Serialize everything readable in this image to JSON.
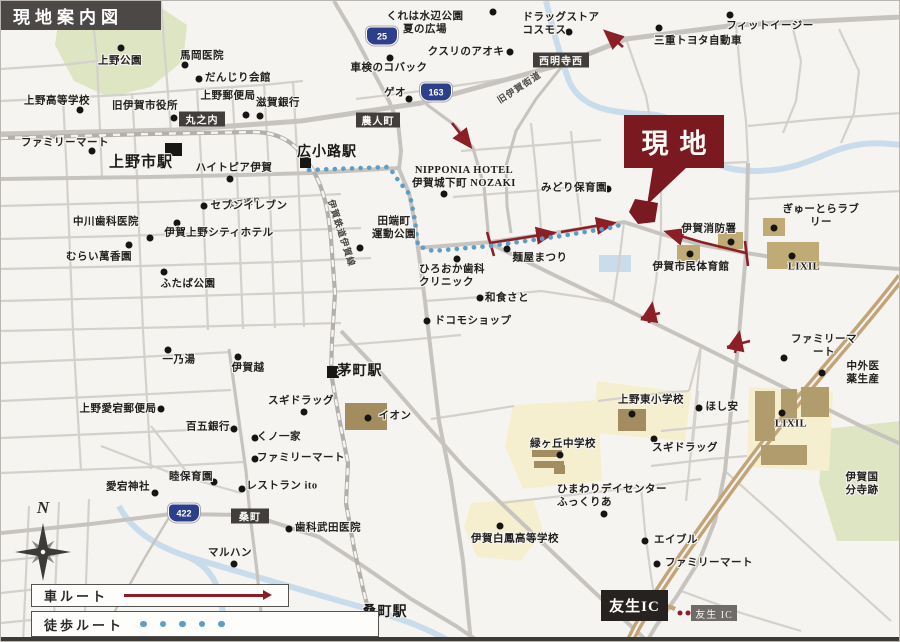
{
  "header": {
    "title": "現地案内図"
  },
  "site": {
    "label": "現地"
  },
  "legend": {
    "car_label": "車ルート",
    "walk_label": "徒歩ルート"
  },
  "compass": {
    "north_label": "N"
  },
  "ic": {
    "primary": "友生IC",
    "secondary": "友生 IC"
  },
  "colors": {
    "site": "#7a1a20",
    "car": "#8c1f26",
    "walk": "#5f9dc6",
    "road": "#c7c4bf",
    "river": "#c9dcec",
    "green": "#dde5c3",
    "campus": "#f6efcf",
    "building": "#c0ab77",
    "highway": "#c2a478"
  },
  "map": {
    "shields": [
      {
        "n": "25",
        "x": 381,
        "y": 35
      },
      {
        "n": "163",
        "x": 435,
        "y": 91
      },
      {
        "n": "422",
        "x": 183,
        "y": 512
      }
    ],
    "dboxes": [
      {
        "t": "丸之内",
        "x": 201,
        "y": 118,
        "w": 46,
        "h": 15
      },
      {
        "t": "農人町",
        "x": 377,
        "y": 119,
        "w": 44,
        "h": 15
      },
      {
        "t": "西明寺西",
        "x": 560,
        "y": 59,
        "w": 56,
        "h": 15
      },
      {
        "t": "桑町",
        "x": 249,
        "y": 515,
        "w": 38,
        "h": 15
      }
    ],
    "stations": [
      {
        "t": "上野市駅",
        "x": 140,
        "y": 160,
        "fs": 15,
        "sq": [
          164,
          142,
          17,
          13
        ]
      },
      {
        "t": "広小路駅",
        "x": 326,
        "y": 150,
        "fs": 14,
        "sq": [
          299,
          156,
          11,
          11
        ]
      },
      {
        "t": "茅町駅",
        "x": 359,
        "y": 369,
        "fs": 14,
        "sq": [
          326,
          365,
          12,
          12
        ]
      },
      {
        "t": "桑町駅",
        "x": 384,
        "y": 610,
        "fs": 14,
        "sq": [
          357,
          616,
          15,
          13
        ]
      }
    ],
    "rotated": [
      {
        "t": "伊賀鉄道伊賀線",
        "x": 341,
        "y": 232,
        "rot": 72,
        "fs": 9
      },
      {
        "t": "旧伊賀街道",
        "x": 518,
        "y": 86,
        "rot": -33,
        "fs": 9
      },
      {
        "t": "本町通り",
        "x": 243,
        "y": 202,
        "rot": -8,
        "fs": 8
      }
    ],
    "pois": [
      {
        "t": "上野公園",
        "x": 119,
        "y": 60,
        "dx": 120,
        "dy": 47
      },
      {
        "t": "馬岡医院",
        "x": 201,
        "y": 55,
        "dx": 184,
        "dy": 64
      },
      {
        "t": "だんじり会館",
        "x": 237,
        "y": 77,
        "dx": 198,
        "dy": 78
      },
      {
        "t": "上野郵便局",
        "x": 227,
        "y": 95,
        "dx": 245,
        "dy": 114
      },
      {
        "t": "滋賀銀行",
        "x": 277,
        "y": 102,
        "dx": 259,
        "dy": 115
      },
      {
        "t": "上野高等学校",
        "x": 56,
        "y": 100,
        "dx": 79,
        "dy": 109
      },
      {
        "t": "旧伊賀市役所",
        "x": 144,
        "y": 105,
        "dx": 173,
        "dy": 117
      },
      {
        "t": "ファミリーマート",
        "x": 64,
        "y": 142,
        "dx": 91,
        "dy": 150
      },
      {
        "t": "ハイトピア伊賀",
        "x": 233,
        "y": 167,
        "dx": 229,
        "dy": 178
      },
      {
        "t": "中川歯科医院",
        "x": 105,
        "y": 221,
        "dx": 149,
        "dy": 237
      },
      {
        "t": "セブンイレブン",
        "x": 248,
        "y": 205,
        "dx": 203,
        "dy": 205
      },
      {
        "t": "伊賀上野シティホテル",
        "x": 218,
        "y": 232,
        "dx": 176,
        "dy": 222
      },
      {
        "t": "むらい萬香園",
        "x": 98,
        "y": 256,
        "dx": 128,
        "dy": 244
      },
      {
        "t": "ふたば公園",
        "x": 187,
        "y": 283,
        "dx": 163,
        "dy": 271
      },
      {
        "t": "くれは水辺公園\n夏の広場",
        "x": 424,
        "y": 22,
        "dx": 492,
        "dy": 11
      },
      {
        "t": "ドラッグストア\nコスモス",
        "x": 560,
        "y": 23,
        "dx": 568,
        "dy": 31,
        "ta": "left"
      },
      {
        "t": "クスリのアオキ",
        "x": 465,
        "y": 51,
        "dx": 509,
        "dy": 51
      },
      {
        "t": "車検のコバック",
        "x": 388,
        "y": 67,
        "dx": 389,
        "dy": 57
      },
      {
        "t": "ゲオ",
        "x": 394,
        "y": 92,
        "dx": 408,
        "dy": 98
      },
      {
        "t": "フィットイージー",
        "x": 769,
        "y": 25,
        "dx": 729,
        "dy": 14
      },
      {
        "t": "三重トヨタ自動車",
        "x": 697,
        "y": 40,
        "dx": 658,
        "dy": 27
      },
      {
        "t": "NIPPONIA HOTEL\n伊賀城下町 NOZAKI",
        "x": 463,
        "y": 176,
        "dx": 443,
        "dy": 193
      },
      {
        "t": "みどり保育園",
        "x": 573,
        "y": 187,
        "dx": 607,
        "dy": 188
      },
      {
        "t": "田端町\n運動公園",
        "x": 393,
        "y": 227,
        "dx": 359,
        "dy": 247
      },
      {
        "t": "ひろおか歯科\nクリニック",
        "x": 451,
        "y": 275,
        "dx": 456,
        "dy": 258,
        "ta": "left"
      },
      {
        "t": "麺屋まつり",
        "x": 539,
        "y": 257,
        "dx": 506,
        "dy": 248
      },
      {
        "t": "和食さと",
        "x": 506,
        "y": 297,
        "dx": 479,
        "dy": 297
      },
      {
        "t": "ドコモショップ",
        "x": 472,
        "y": 320,
        "dx": 426,
        "dy": 320
      },
      {
        "t": "伊賀消防署",
        "x": 708,
        "y": 228,
        "dx": 730,
        "dy": 241
      },
      {
        "t": "ぎゅーとらラブリー",
        "x": 820,
        "y": 215,
        "dx": 773,
        "dy": 227
      },
      {
        "t": "LIXIL",
        "x": 803,
        "y": 266,
        "dx": 791,
        "dy": 255
      },
      {
        "t": "伊賀市民体育館",
        "x": 690,
        "y": 266,
        "dx": 689,
        "dy": 253
      },
      {
        "t": "ファミリーマート",
        "x": 823,
        "y": 345,
        "dx": 783,
        "dy": 357
      },
      {
        "t": "中外医薬生産",
        "x": 862,
        "y": 372,
        "dx": 821,
        "dy": 372
      },
      {
        "t": "一乃湯",
        "x": 178,
        "y": 359,
        "dx": 167,
        "dy": 349
      },
      {
        "t": "伊賀越",
        "x": 247,
        "y": 367,
        "dx": 237,
        "dy": 356
      },
      {
        "t": "上野愛宕郵便局",
        "x": 117,
        "y": 408,
        "dx": 160,
        "dy": 408
      },
      {
        "t": "百五銀行",
        "x": 207,
        "y": 426,
        "dx": 233,
        "dy": 428
      },
      {
        "t": "くノ一家",
        "x": 278,
        "y": 436,
        "dx": 254,
        "dy": 437
      },
      {
        "t": "ファミリーマート",
        "x": 300,
        "y": 457,
        "dx": 254,
        "dy": 458
      },
      {
        "t": "睦保育園",
        "x": 190,
        "y": 476,
        "dx": 213,
        "dy": 481
      },
      {
        "t": "愛宕神社",
        "x": 127,
        "y": 486,
        "dx": 154,
        "dy": 492
      },
      {
        "t": "レストラン ito",
        "x": 281,
        "y": 485,
        "dx": 241,
        "dy": 488
      },
      {
        "t": "スギドラッグ",
        "x": 300,
        "y": 400,
        "dx": 303,
        "dy": 411
      },
      {
        "t": "イオン",
        "x": 394,
        "y": 415,
        "dx": 367,
        "dy": 417
      },
      {
        "t": "緑ヶ丘中学校",
        "x": 562,
        "y": 443,
        "dx": 559,
        "dy": 454
      },
      {
        "t": "上野東小学校",
        "x": 650,
        "y": 399,
        "dx": 631,
        "dy": 413
      },
      {
        "t": "ほし安",
        "x": 721,
        "y": 406,
        "dx": 698,
        "dy": 407
      },
      {
        "t": "スギドラッグ",
        "x": 684,
        "y": 447,
        "dx": 653,
        "dy": 438
      },
      {
        "t": "LIXIL",
        "x": 790,
        "y": 423,
        "dx": 781,
        "dy": 412
      },
      {
        "t": "ひまわりデイセンター\nふっくりあ",
        "x": 611,
        "y": 495,
        "dx": 603,
        "dy": 513,
        "ta": "left"
      },
      {
        "t": "伊賀白鳳高等学校",
        "x": 514,
        "y": 538,
        "dx": 499,
        "dy": 525
      },
      {
        "t": "エイブル",
        "x": 675,
        "y": 539,
        "dx": 644,
        "dy": 540
      },
      {
        "t": "ファミリーマート",
        "x": 708,
        "y": 562,
        "dx": 656,
        "dy": 563
      },
      {
        "t": "伊賀国分寺跡",
        "x": 861,
        "y": 483
      },
      {
        "t": "マルハン",
        "x": 229,
        "y": 552,
        "dx": 233,
        "dy": 563
      },
      {
        "t": "歯科武田医院",
        "x": 327,
        "y": 527,
        "dx": 288,
        "dy": 528
      }
    ]
  }
}
